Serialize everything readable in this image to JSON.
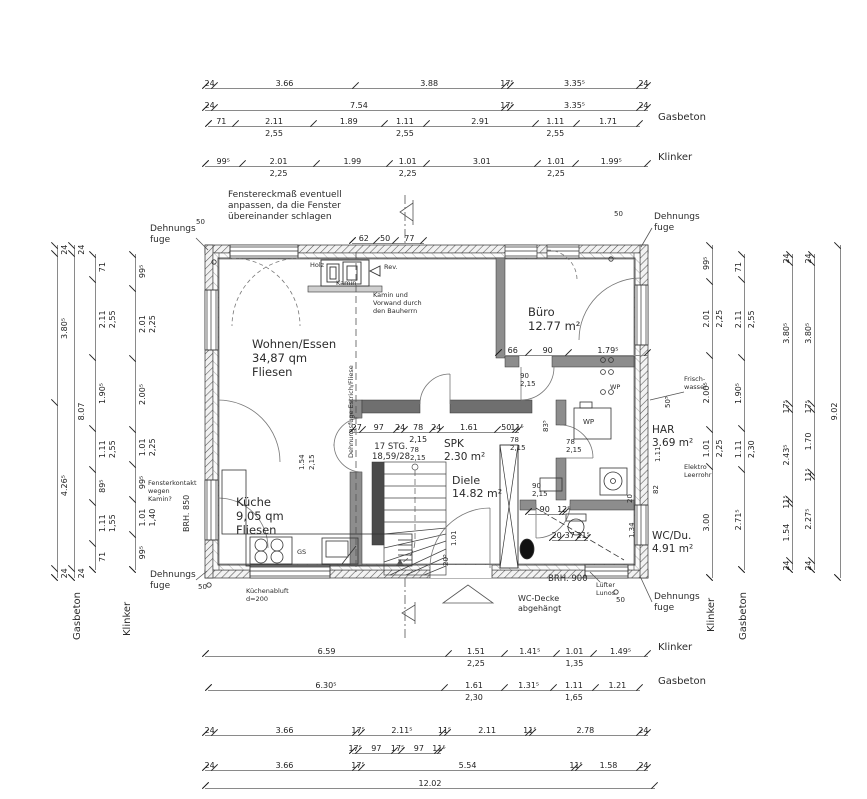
{
  "materials": {
    "gasbeton": "Gasbeton",
    "klinker": "Klinker"
  },
  "rooms": {
    "wohnen": {
      "name": "Wohnen/Essen",
      "area": "34,87 qm",
      "floor": "Fliesen"
    },
    "buero": {
      "name": "Büro",
      "area": "12.77 m²"
    },
    "kueche": {
      "name": "Küche",
      "area": "9,05 qm",
      "floor": "Fliesen"
    },
    "diele": {
      "name": "Diele",
      "area": "14.82 m²"
    },
    "spk": {
      "name": "SPK",
      "area": "2.30 m²"
    },
    "wc": {
      "name": "WC/Du.",
      "area": "4.91 m²"
    },
    "har": {
      "name": "HAR",
      "area": "3.69 m²"
    }
  },
  "notes": {
    "fenster": "Fenstereckmaß eventuell\nanpassen, da die Fenster\nübereinander schlagen",
    "dehnungsfuge": "Dehnungs\nfuge",
    "kamin_vorwand": "Kamin und\nVorwand durch\nden Bauherrn",
    "holz": "Holz",
    "kamin": "Kamin",
    "rev": "Rev.",
    "estrich": "Dehnungsfuge Estrich/Fliese",
    "stg": "17 STG.\n18,59/28",
    "brh850": "BRH. 850",
    "brh900": "BRH. 900",
    "fensterkontakt": "Fensterkontakt\nwegen\nKamin?",
    "kuechenabluft": "Küchenabluft\nd=200",
    "wcdecke": "WC-Decke\nabgehängt",
    "luefter": "Lüfter\nLunos",
    "elektro": "Elektro\nLeerrohr",
    "frischwasser": "Frisch-\nwasser",
    "wp": "WP",
    "gs": "GS",
    "fuge50": "50"
  },
  "dims": {
    "top": [
      {
        "values": [
          "24",
          "3.66",
          "3.88",
          "17⁵",
          "3.35⁵",
          "24"
        ]
      },
      {
        "values": [
          "24",
          "7.54",
          "17⁵",
          "3.35⁵",
          "24"
        ]
      },
      {
        "values": [
          "71",
          "2.11",
          "1.89",
          "1.11",
          "2.91",
          "1.11",
          "1.71"
        ],
        "subs": [
          "",
          "2,55",
          "",
          "2,55",
          "",
          "2,55",
          ""
        ]
      },
      {
        "values": [
          "99⁵",
          "2.01",
          "1.99",
          "1.01",
          "3.01",
          "1.01",
          "1.99⁵"
        ],
        "subs": [
          "",
          "2,25",
          "",
          "2,25",
          "",
          "2,25",
          ""
        ]
      }
    ],
    "top_small": {
      "values": [
        "62",
        "50",
        "77"
      ]
    },
    "bottom": [
      {
        "values": [
          "6.59",
          "1.51",
          "1.41⁵",
          "1.01",
          "1.49⁵"
        ],
        "subs": [
          "",
          "2,25",
          "",
          "1,35",
          ""
        ]
      },
      {
        "values": [
          "6.30⁵",
          "1.61",
          "1.31⁵",
          "1.11",
          "1.21"
        ],
        "subs": [
          "",
          "2,30",
          "",
          "1,65",
          ""
        ]
      },
      {
        "values": [
          "24",
          "3.66",
          "17⁵",
          "2.11⁵",
          "11⁵",
          "2.11",
          "11⁵",
          "2.78",
          "24"
        ]
      },
      {
        "values": [
          "17⁵",
          "97",
          "17⁵",
          "97",
          "11⁵"
        ]
      },
      {
        "values": [
          "24",
          "3.66",
          "17⁵",
          "5.54",
          "11⁵",
          "1.58",
          "24"
        ]
      },
      {
        "values": [
          "12.02"
        ]
      }
    ],
    "left": [
      {
        "values": [
          "24",
          "3.80⁵",
          "4.26⁵",
          "24"
        ]
      },
      {
        "values": [
          "24",
          "8.07",
          "24"
        ]
      },
      {
        "values": [
          "71",
          "2.11",
          "1.90⁵",
          "1.11",
          "89⁵",
          "1.11",
          "71"
        ],
        "subs": [
          "",
          "2,55",
          "",
          "2,55",
          "",
          "1,55",
          ""
        ]
      },
      {
        "values": [
          "99⁵",
          "2.01",
          "2.00⁵",
          "1.01",
          "99⁵",
          "1.01",
          "99⁵"
        ],
        "subs": [
          "",
          "2,25",
          "",
          "2,25",
          "",
          "1,40",
          ""
        ]
      }
    ],
    "right": [
      {
        "values": [
          "99⁵",
          "2.01",
          "2.00⁵",
          "1.01",
          "3.00"
        ],
        "subs": [
          "",
          "2,25",
          "",
          "2,25",
          ""
        ]
      },
      {
        "values": [
          "71",
          "2.11",
          "1.90⁵",
          "1.11",
          "2.71⁵"
        ],
        "subs": [
          "",
          "2,55",
          "",
          "2,30",
          ""
        ]
      },
      {
        "values": [
          "24",
          "3.80⁵",
          "17⁵",
          "2.43⁵",
          "11⁵",
          "1.54",
          "24"
        ]
      },
      {
        "values": [
          "24",
          "3.80⁵",
          "17⁵",
          "1.70",
          "11⁵",
          "2.27⁵",
          "24"
        ]
      },
      {
        "values": [
          "9.02"
        ]
      }
    ],
    "interior": [
      {
        "values": [
          "27",
          "97",
          "24",
          "78",
          "24",
          "1.61",
          "50",
          "11⁵"
        ],
        "subs": [
          "",
          "",
          "",
          "2,15",
          "",
          "",
          "",
          ""
        ]
      },
      {
        "values": [
          "66",
          "90",
          "1.79⁵"
        ]
      },
      {
        "values": [
          "20",
          "37",
          "21⁵"
        ]
      },
      {
        "values": [
          "90",
          "12⁵"
        ]
      }
    ],
    "labels": {
      "door_buero": "90\n2,15",
      "door_wc": "90\n2,15",
      "door_spk": "78\n2,15",
      "door_har1": "78\n2,15",
      "door_har2": "78\n2,15",
      "dd1": "1.54",
      "dd2": "2,15",
      "v83": "83⁵",
      "v101": "1.01",
      "v20a": "20⁵",
      "v134": "1.34",
      "v20b": "20",
      "v111": "1.11",
      "v82": "82",
      "v50": "50⁵"
    }
  }
}
